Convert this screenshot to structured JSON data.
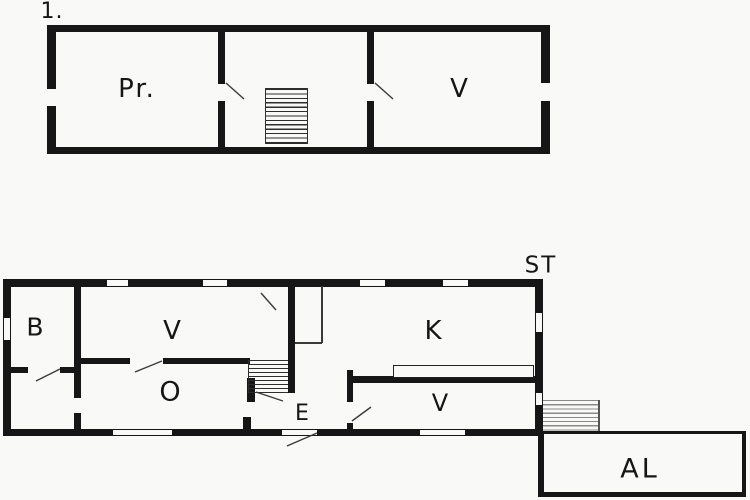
{
  "colors": {
    "wall": "#161616",
    "thin_line": "#3a3a3a",
    "background": "#f9f9f7"
  },
  "upper_floor": {
    "floor_number_label": "1.",
    "room_pr_label": "Pr.",
    "room_v_label": "V"
  },
  "ground_floor": {
    "stairs_label": "ST",
    "room_b_label": "B",
    "room_v_label": "V",
    "room_k_label": "K",
    "room_o_label": "O",
    "room_e_label": "E",
    "room_v_lower_label": "V",
    "annex_label": "AL"
  }
}
